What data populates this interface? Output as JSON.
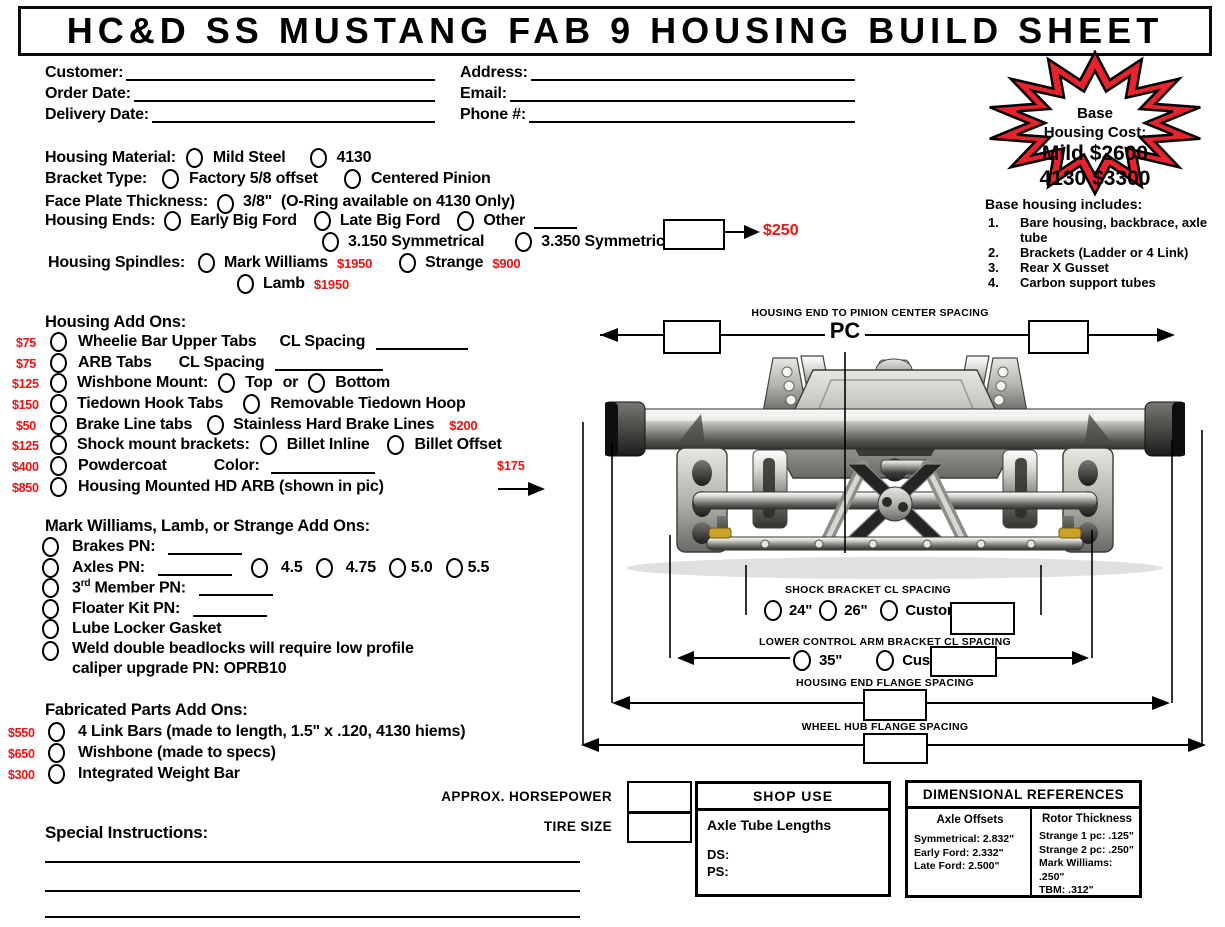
{
  "title": "HC&D SS MUSTANG FAB 9 HOUSING BUILD SHEET",
  "colors": {
    "price_red": "#ee1212",
    "star_red": "#e8232e"
  },
  "customer": {
    "customer_label": "Customer:",
    "order_date_label": "Order Date:",
    "delivery_date_label": "Delivery Date:",
    "address_label": "Address:",
    "email_label": "Email:",
    "phone_label": "Phone #:"
  },
  "star": {
    "l1": "Base",
    "l2": "Housing Cost:",
    "l3": "Mild $2600",
    "l4": "4130 $3300"
  },
  "base_includes": {
    "heading": "Base housing includes:",
    "items": [
      {
        "n": "1.",
        "text": "Bare housing, backbrace, axle tube"
      },
      {
        "n": "2.",
        "text": "Brackets (Ladder or 4 Link)"
      },
      {
        "n": "3.",
        "text": "Rear X Gusset"
      },
      {
        "n": "4.",
        "text": "Carbon support tubes"
      }
    ]
  },
  "form": {
    "material": {
      "label": "Housing Material:",
      "opt1": "Mild Steel",
      "opt2": "4130"
    },
    "bracket": {
      "label": "Bracket Type:",
      "opt1": "Factory 5/8 offset",
      "opt2": "Centered Pinion"
    },
    "faceplate": {
      "label": "Face Plate Thickness:",
      "opt1": "3/8\"",
      "note": "(O-Ring available on 4130 Only)"
    },
    "ends": {
      "label": "Housing Ends:",
      "opt1": "Early Big Ford",
      "opt2": "Late Big Ford",
      "opt3": "Other",
      "opt4": "3.150 Symmetrical",
      "opt5": "3.350 Symmetrical",
      "price": "$250"
    },
    "spindles": {
      "label": "Housing Spindles:",
      "opt1": "Mark Williams",
      "price1": "$1950",
      "opt2": "Strange",
      "price2": "$900",
      "opt3": "Lamb",
      "price3": "$1950"
    }
  },
  "addons": {
    "heading": "Housing Add Ons:",
    "rows": [
      {
        "price": "$75",
        "label": "Wheelie Bar Upper Tabs",
        "extra": "CL Spacing"
      },
      {
        "price": "$75",
        "label": "ARB Tabs",
        "extra": "CL Spacing"
      },
      {
        "price": "$125",
        "label": "Wishbone Mount:",
        "opt1": "Top",
        "joiner": "or",
        "opt2": "Bottom"
      },
      {
        "price": "$150",
        "label": "Tiedown Hook Tabs",
        "opt1": "Removable Tiedown Hoop"
      },
      {
        "price": "$50",
        "label": "Brake Line tabs",
        "opt1": "Stainless Hard Brake Lines",
        "opt1_price": "$200"
      },
      {
        "price": "$125",
        "label": "Shock mount brackets:",
        "opt1": "Billet Inline",
        "opt2": "Billet Offset",
        "opt2_price": "$175"
      },
      {
        "price": "$400",
        "label": "Powdercoat",
        "extra": "Color:"
      },
      {
        "price": "$850",
        "label": "Housing Mounted HD ARB (shown in pic)"
      }
    ]
  },
  "mw": {
    "heading": "Mark Williams, Lamb, or Strange Add Ons:",
    "brakes": "Brakes PN:",
    "axles": "Axles PN:",
    "ratios": [
      "4.5",
      "4.75",
      "5.0",
      "5.5"
    ],
    "member_pre": "3",
    "member_sup": "rd",
    "member_post": " Member PN:",
    "floater": "Floater Kit PN:",
    "lube": "Lube Locker Gasket",
    "weld_line1": "Weld double beadlocks will require low profile",
    "weld_line2": "caliper upgrade PN: OPRB10"
  },
  "fab": {
    "heading": "Fabricated Parts Add Ons:",
    "rows": [
      {
        "price": "$550",
        "label": "4 Link Bars (made to length, 1.5\" x .120, 4130 hiems)"
      },
      {
        "price": "$650",
        "label": "Wishbone (made to specs)"
      },
      {
        "price": "$300",
        "label": "Integrated Weight Bar"
      }
    ]
  },
  "diagram": {
    "pc_label": "HOUSING END TO PINION CENTER SPACING",
    "pc": "PC",
    "shock_label": "SHOCK BRACKET CL SPACING",
    "shock_opt1": "24\"",
    "shock_opt2": "26\"",
    "shock_opt3": "Custom",
    "lca_label": "LOWER CONTROL ARM BRACKET CL SPACING",
    "lca_opt1": "35\"",
    "lca_opt2": "Custom",
    "hef_label": "HOUSING END FLANGE SPACING",
    "whf_label": "WHEEL HUB FLANGE SPACING"
  },
  "bottom": {
    "hp_label": "APPROX. HORSEPOWER",
    "tire_label": "TIRE SIZE",
    "special_label": "Special Instructions:",
    "shop": {
      "title": "SHOP USE",
      "line": "Axle Tube Lengths",
      "ds": "DS:",
      "ps": "PS:"
    },
    "dim": {
      "title": "DIMENSIONAL REFERENCES",
      "axle_heading": "Axle Offsets",
      "axle_items": [
        "Symmetrical: 2.832\"",
        "Early Ford: 2.332\"",
        "Late Ford: 2.500\""
      ],
      "rotor_heading": "Rotor Thickness",
      "rotor_items": [
        "Strange 1 pc: .125\"",
        "Strange 2 pc: .250\"",
        "Mark Williams: .250\"",
        "TBM: .312\""
      ]
    }
  }
}
